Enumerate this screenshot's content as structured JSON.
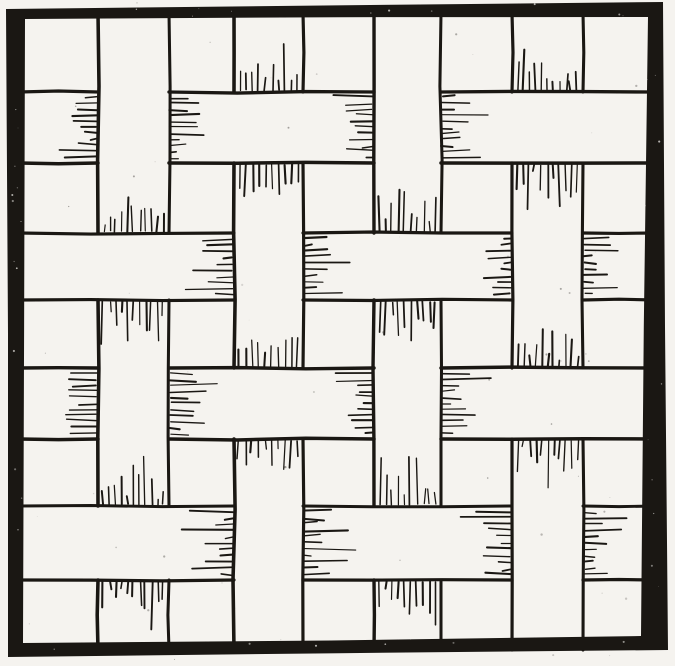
{
  "figure": {
    "type": "woodcut-weave-diagram",
    "description": "Woodcut-style illustration of a plain basket weave: four vertical strips interlaced over and under four horizontal strips inside a thick black hand-drawn frame. Short hatch lines shade each strip where it passes underneath a crossing strip."
  },
  "canvas": {
    "width": 675,
    "height": 666
  },
  "colors": {
    "paper": "#f5f3ef",
    "ink": "#1a1713"
  },
  "frame": {
    "outer": [
      [
        6,
        9
      ],
      [
        663,
        2
      ],
      [
        668,
        650
      ],
      [
        8,
        657
      ]
    ],
    "inner": [
      [
        25,
        19
      ],
      [
        648,
        17
      ],
      [
        641,
        636
      ],
      [
        23,
        643
      ]
    ]
  },
  "weave": {
    "interlacing_rule": "plain weave: vertical strip on top where matrix cell is V, horizontal strip on top where cell is H",
    "vertical_strips": [
      {
        "id": "v1",
        "x_left": 98,
        "x_right": 169
      },
      {
        "id": "v2",
        "x_left": 234,
        "x_right": 303
      },
      {
        "id": "v3",
        "x_left": 374,
        "x_right": 441
      },
      {
        "id": "v4",
        "x_left": 512,
        "x_right": 583
      }
    ],
    "horizontal_strips": [
      {
        "id": "h1",
        "y_top": 92,
        "y_bottom": 163
      },
      {
        "id": "h2",
        "y_top": 233,
        "y_bottom": 300
      },
      {
        "id": "h3",
        "y_top": 368,
        "y_bottom": 439
      },
      {
        "id": "h4",
        "y_top": 506,
        "y_bottom": 580
      }
    ],
    "over_matrix": [
      [
        "V",
        "H",
        "V",
        "H"
      ],
      [
        "H",
        "V",
        "H",
        "V"
      ],
      [
        "V",
        "H",
        "V",
        "H"
      ],
      [
        "H",
        "V",
        "H",
        "V"
      ]
    ]
  },
  "style": {
    "edge_width": 3.2,
    "hatch": {
      "spacing": 6.2,
      "min_length": 6,
      "max_length": 30,
      "long_stroke_chance": 0.22,
      "stroke_width": 1.5,
      "edge_inset": 5.5
    },
    "specks": {
      "paper_specks": 58,
      "frame_pits": 42
    }
  }
}
